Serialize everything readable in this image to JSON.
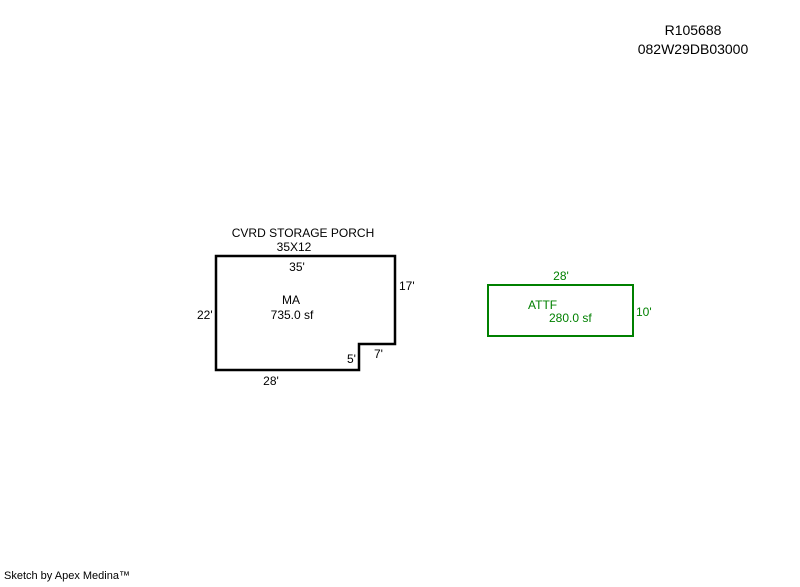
{
  "page": {
    "background": "#ffffff"
  },
  "header": {
    "line1": "R105688",
    "line2": "082W29DB03000"
  },
  "sketch": {
    "main": {
      "caption_line1": "CVRD STORAGE PORCH",
      "caption_line2": "35X12",
      "code": "MA",
      "area": "735.0 sf",
      "dim_top": "35'",
      "dim_right": "17'",
      "dim_left": "22'",
      "dim_bottom": "28'",
      "dim_notch_top": "7'",
      "dim_notch_side": "5'"
    },
    "attf": {
      "code": "ATTF",
      "area": "280.0 sf",
      "dim_top": "28'",
      "dim_right": "10'"
    }
  },
  "colors": {
    "main_outline": "#000000",
    "attf_outline": "#008000",
    "attf_text": "#008000"
  },
  "footer": {
    "credit": "Sketch by Apex Medina™"
  }
}
